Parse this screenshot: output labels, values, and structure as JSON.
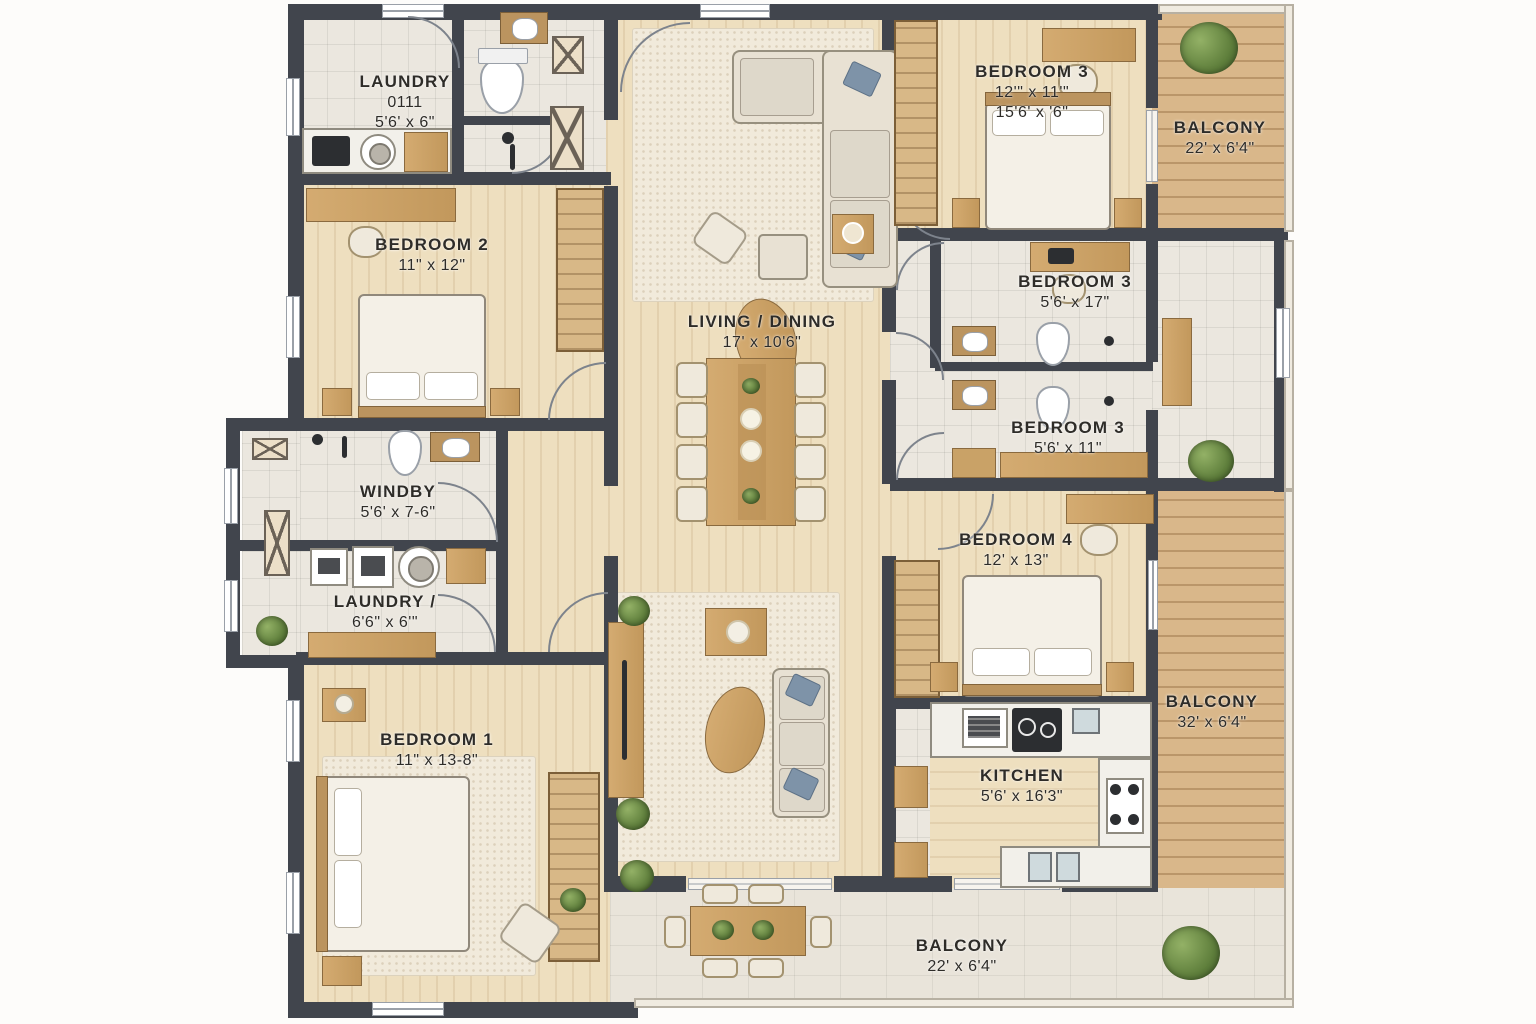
{
  "title": "Apartment Floor Plan",
  "rooms": {
    "laundry_top": {
      "name": "LAUNDRY",
      "num": "0111",
      "dims": "5'6' x 6\""
    },
    "bedroom2": {
      "name": "BEDROOM 2",
      "dims": "11\" x 12\""
    },
    "bedroom3_top": {
      "name": "BEDROOM 3",
      "dims": "12'\" x 11'\"",
      "dims2": "15'6' x '6\""
    },
    "balcony_top": {
      "name": "BALCONY",
      "dims": "22' x 6'4\""
    },
    "bedroom3_mid": {
      "name": "BEDROOM 3",
      "dims": "5'6' x 17\""
    },
    "living": {
      "name": "LIVING / DINING",
      "dims": "17' x 10'6\""
    },
    "bedroom3_low": {
      "name": "BEDROOM 3",
      "dims": "5'6' x 11\""
    },
    "windby": {
      "name": "WINDBY",
      "dims": "5'6' x 7-6\""
    },
    "laundry_left": {
      "name": "LAUNDRY /",
      "dims": "6'6\" x 6'\""
    },
    "bedroom1": {
      "name": "BEDROOM 1",
      "dims": "11\" x 13-8\""
    },
    "bedroom4": {
      "name": "BEDROOM 4",
      "dims": "12' x 13\""
    },
    "kitchen": {
      "name": "KITCHEN",
      "dims": "5'6' x 16'3\""
    },
    "balcony_right": {
      "name": "BALCONY",
      "dims": "32' x 6'4\""
    },
    "balcony_bottom": {
      "name": "BALCONY",
      "dims": "22' x 6'4\""
    }
  },
  "colors": {
    "wall": "#41454d",
    "wood_floor": "#eedfbf",
    "tile_floor": "#ebe7df",
    "deck": "#d9b78a",
    "stone": "#e9e4da",
    "furniture_wood": "#c9a267",
    "plant": "#5f7f3c",
    "label_text": "#2e2c28"
  }
}
